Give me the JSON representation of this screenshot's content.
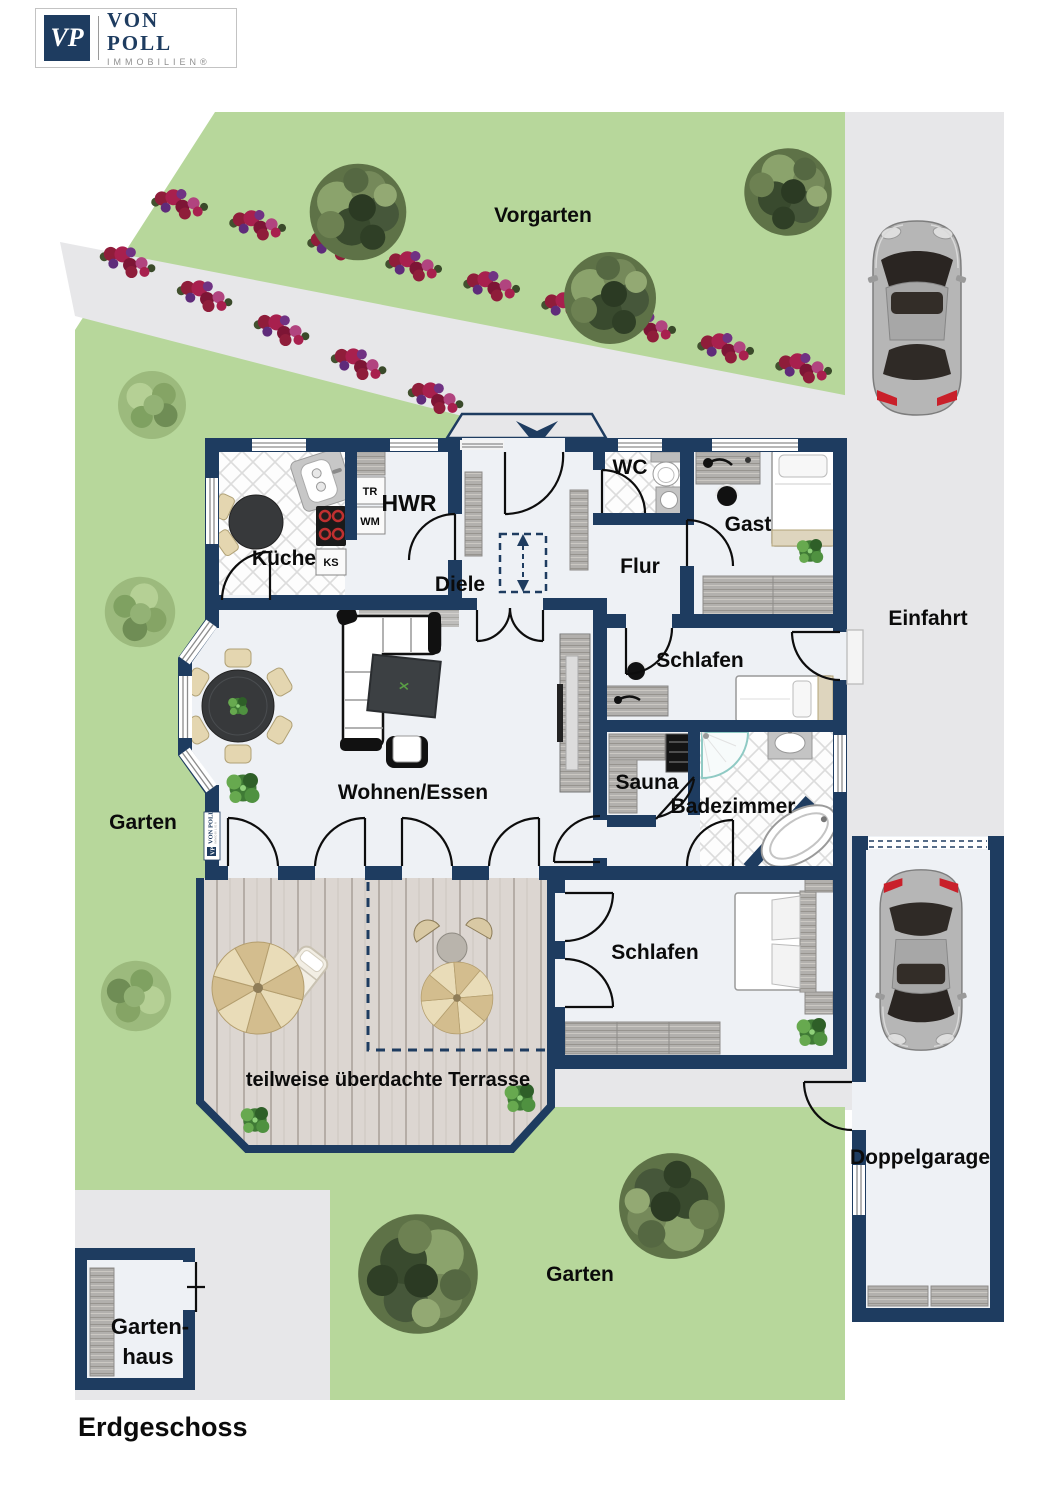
{
  "logo": {
    "monogram": "VP",
    "brand": "VON POLL",
    "subtitle": "IMMOBILIEN®"
  },
  "plan_title": "Erdgeschoss",
  "outdoor": {
    "vorgarten": "Vorgarten",
    "garten_left": "Garten",
    "garten_bottom": "Garten",
    "einfahrt": "Einfahrt",
    "terrasse": "teilweise überdachte Terrasse",
    "doppelgarage": "Doppelgarage",
    "gartenhaus_line1": "Garten-",
    "gartenhaus_line2": "haus"
  },
  "rooms": {
    "kueche": "Küche",
    "hwr": "HWR",
    "diele": "Diele",
    "wc": "WC",
    "flur": "Flur",
    "gast": "Gast",
    "schlafen_oben": "Schlafen",
    "sauna": "Sauna",
    "badezimmer": "Badezimmer",
    "wohnen_essen": "Wohnen/Essen",
    "schlafen_unten": "Schlafen"
  },
  "appliances": {
    "tr": "TR",
    "wm": "WM",
    "ks": "KS"
  },
  "watermark": {
    "brand": "VON POLL",
    "subtitle": "IMMOBILIEN",
    "monogram": "VP"
  },
  "colors": {
    "wall": "#1e3c60",
    "grass": "#b7d79b",
    "path": "#e7e7e9",
    "floor": "#eef1f5",
    "deck": "#dcd6d1",
    "flower_red": "#9c1f3d",
    "flower_purple": "#6a2f86",
    "car_body": "#b6b6b6"
  }
}
